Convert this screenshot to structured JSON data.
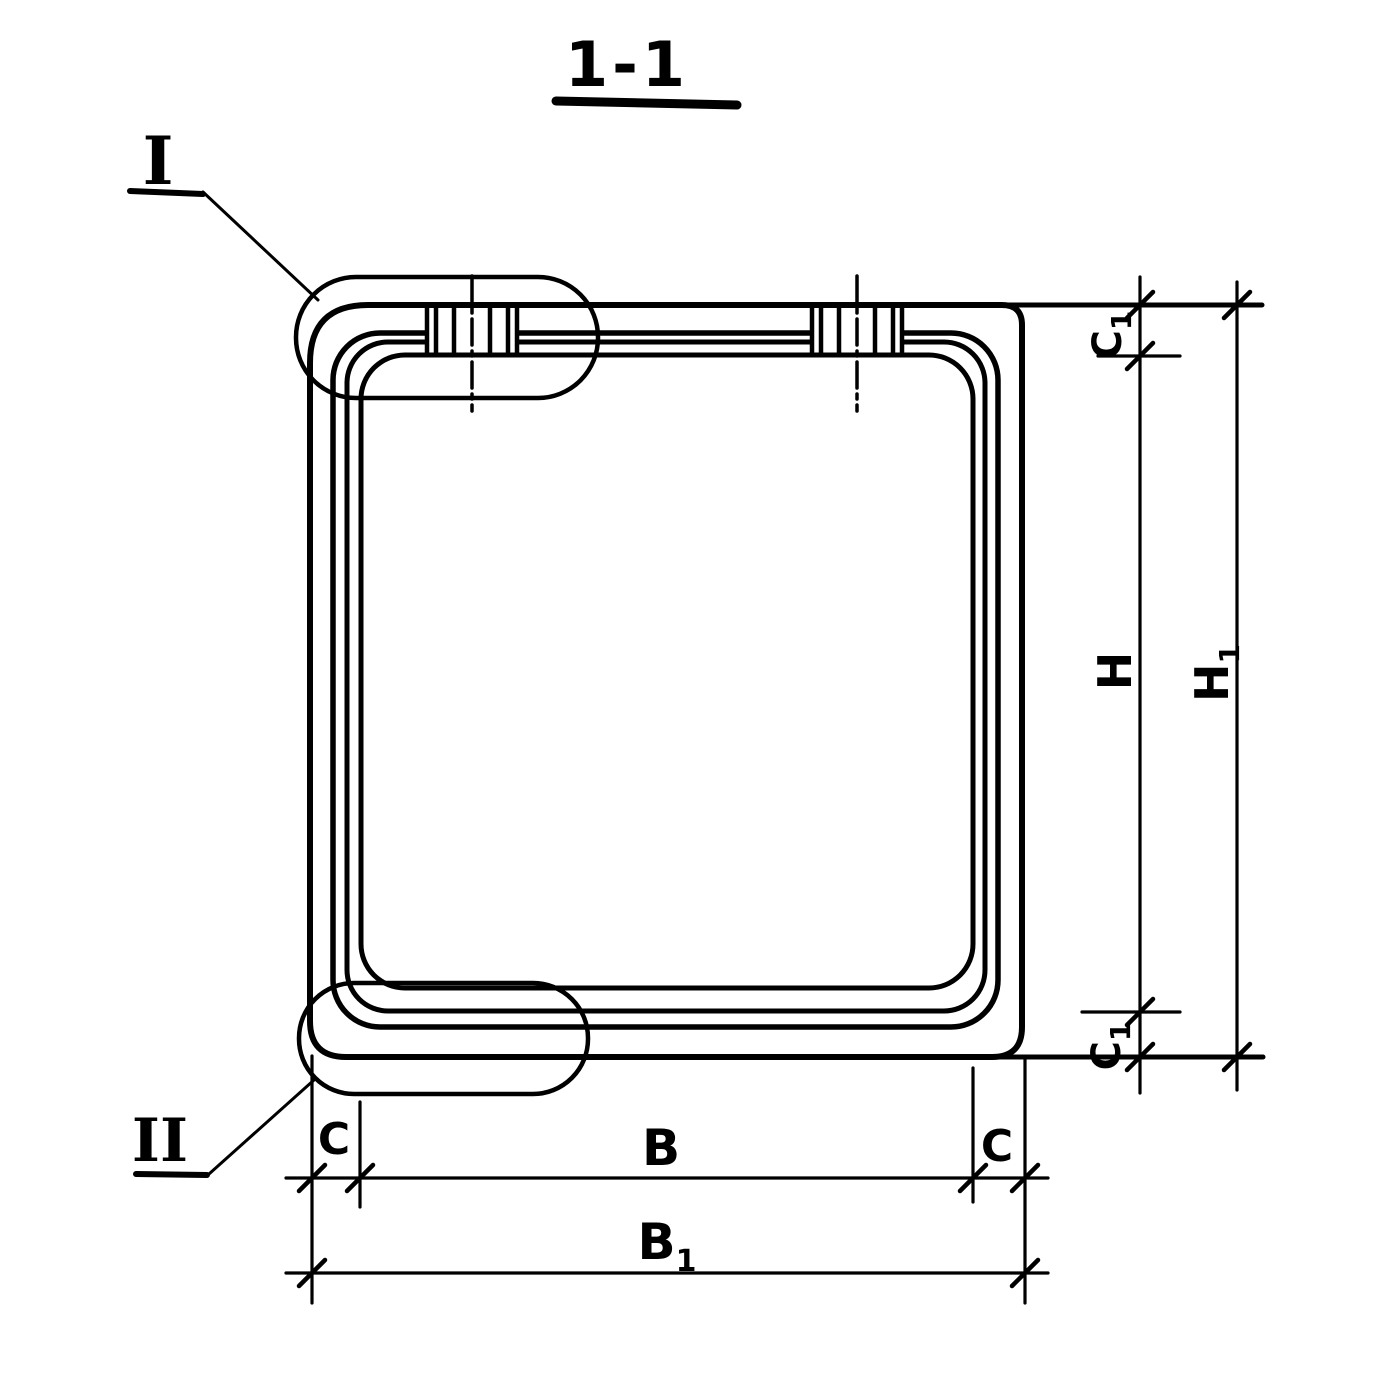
{
  "colors": {
    "ink": "#000000",
    "paper": "#ffffff"
  },
  "title": "1-1",
  "callouts": {
    "detail_1": "I",
    "detail_2": "II"
  },
  "dim_labels": {
    "c1_top": {
      "base": "C",
      "sub": "1"
    },
    "h": {
      "base": "H",
      "sub": ""
    },
    "c1_bottom": {
      "base": "C",
      "sub": "1"
    },
    "h1": {
      "base": "H",
      "sub": "1"
    },
    "c_left": {
      "base": "C",
      "sub": ""
    },
    "b": {
      "base": "B",
      "sub": ""
    },
    "c_right": {
      "base": "C",
      "sub": ""
    },
    "b1": {
      "base": "B",
      "sub": "1"
    }
  }
}
